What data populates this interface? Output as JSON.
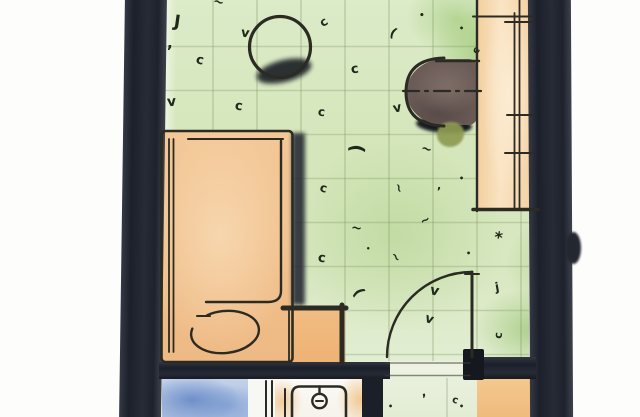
{
  "scene": {
    "type": "floor-plan-sketch",
    "style": "hand-drawn watercolor",
    "rooms": [
      {
        "id": "main-room",
        "floor": "green-carpet"
      },
      {
        "id": "bathroom",
        "floor": "white-and-orange",
        "fixtures": [
          "shower",
          "toilet"
        ]
      },
      {
        "id": "entry-corridor",
        "floor": "pale-green"
      }
    ],
    "furniture": [
      {
        "id": "bed",
        "color_ref": "furniture_orange"
      },
      {
        "id": "nightstand",
        "color_ref": "furniture_orange"
      },
      {
        "id": "round-table",
        "color_ref": "furniture_orange"
      },
      {
        "id": "armchair",
        "color_ref": "chair_taupe"
      },
      {
        "id": "desk-console",
        "color_ref": "desk_orange"
      },
      {
        "id": "closet",
        "color_ref": "furniture_orange"
      },
      {
        "id": "shower",
        "color_ref": "shower_blue"
      },
      {
        "id": "toilet",
        "color_ref": "ink"
      },
      {
        "id": "door",
        "swing": "quarter-circle"
      }
    ]
  },
  "colors": {
    "wall": "#20242e",
    "ink": "#2b2b23",
    "carpet_green": "#d5e6bb",
    "entry_green": "#e6efdb",
    "furniture_orange": "#f0bf8b",
    "desk_orange": "#f7dab3",
    "chair_taupe": "#6b5b57",
    "shower_blue": "#a9bede",
    "olive_accent": "#8e9b52",
    "shadow": "#1d2127"
  },
  "carpet_marks": [
    {
      "x": 174,
      "y": 14,
      "g": "J",
      "r": 8,
      "s": 17
    },
    {
      "x": 167,
      "y": 36,
      "g": ",",
      "r": 0,
      "s": 15
    },
    {
      "x": 196,
      "y": 54,
      "g": "c",
      "r": 12,
      "s": 13
    },
    {
      "x": 167,
      "y": 95,
      "g": "v",
      "r": -5,
      "s": 14
    },
    {
      "x": 213,
      "y": -4,
      "g": "~",
      "r": 15,
      "s": 13
    },
    {
      "x": 241,
      "y": 27,
      "g": "v",
      "r": 8,
      "s": 13
    },
    {
      "x": 235,
      "y": 100,
      "g": "c",
      "r": 8,
      "s": 13
    },
    {
      "x": 320,
      "y": 16,
      "g": "c",
      "r": -35,
      "s": 12
    },
    {
      "x": 351,
      "y": 63,
      "g": "c",
      "r": -8,
      "s": 13
    },
    {
      "x": 390,
      "y": 27,
      "g": "(",
      "r": 28,
      "s": 13
    },
    {
      "x": 318,
      "y": 106,
      "g": "c",
      "r": 5,
      "s": 12
    },
    {
      "x": 393,
      "y": 102,
      "g": "v",
      "r": -12,
      "s": 13
    },
    {
      "x": 419,
      "y": 12,
      "g": "•",
      "r": 0,
      "s": 9
    },
    {
      "x": 459,
      "y": 25,
      "g": "•",
      "r": 0,
      "s": 8
    },
    {
      "x": 474,
      "y": 46,
      "g": "c",
      "r": -60,
      "s": 10
    },
    {
      "x": 352,
      "y": 139,
      "g": "(",
      "r": 95,
      "s": 19
    },
    {
      "x": 421,
      "y": 143,
      "g": "~",
      "r": 15,
      "s": 13
    },
    {
      "x": 437,
      "y": 180,
      "g": ",",
      "r": 0,
      "s": 11
    },
    {
      "x": 320,
      "y": 182,
      "g": "c",
      "r": 15,
      "s": 12
    },
    {
      "x": 394,
      "y": 182,
      "g": "~",
      "r": 75,
      "s": 12
    },
    {
      "x": 459,
      "y": 175,
      "g": "•",
      "r": 0,
      "s": 8
    },
    {
      "x": 351,
      "y": 222,
      "g": "~",
      "r": 8,
      "s": 13
    },
    {
      "x": 420,
      "y": 214,
      "g": "~",
      "r": -28,
      "s": 12
    },
    {
      "x": 494,
      "y": 230,
      "g": "*",
      "r": 10,
      "s": 16
    },
    {
      "x": 466,
      "y": 250,
      "g": "•",
      "r": 0,
      "s": 8
    },
    {
      "x": 366,
      "y": 246,
      "g": "•",
      "r": 0,
      "s": 7
    },
    {
      "x": 318,
      "y": 252,
      "g": "c",
      "r": 8,
      "s": 13
    },
    {
      "x": 391,
      "y": 251,
      "g": "~",
      "r": 55,
      "s": 12
    },
    {
      "x": 355,
      "y": 285,
      "g": "(",
      "r": 60,
      "s": 15
    },
    {
      "x": 430,
      "y": 284,
      "g": "v",
      "r": 12,
      "s": 14
    },
    {
      "x": 495,
      "y": 281,
      "g": "j",
      "r": -10,
      "s": 12
    },
    {
      "x": 425,
      "y": 313,
      "g": "v",
      "r": 18,
      "s": 13
    },
    {
      "x": 495,
      "y": 330,
      "g": "c",
      "r": -85,
      "s": 11
    },
    {
      "x": 388,
      "y": 403,
      "g": "•",
      "r": 0,
      "s": 8
    },
    {
      "x": 421,
      "y": 386,
      "g": ",",
      "r": -15,
      "s": 12
    },
    {
      "x": 459,
      "y": 403,
      "g": "•",
      "r": 0,
      "s": 8
    },
    {
      "x": 452,
      "y": 396,
      "g": "c",
      "r": 20,
      "s": 10
    }
  ]
}
